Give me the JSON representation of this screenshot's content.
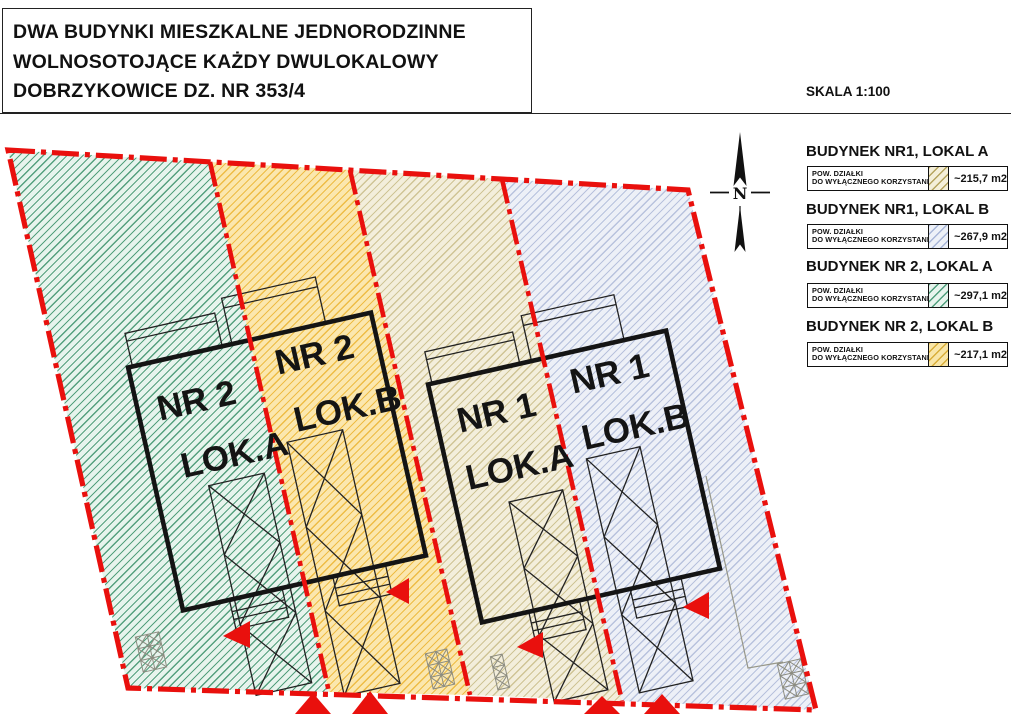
{
  "title": {
    "line1": "DWA BUDYNKI MIESZKALNE JEDNORODZINNE",
    "line2": "WOLNOSOTOJĄCE KAŻDY DWULOKALOWY",
    "line3": "DOBRZYKOWICE DZ. NR 353/4"
  },
  "scale_label": "SKALA 1:100",
  "north": {
    "label": "N"
  },
  "legend": {
    "row_label_line1": "POW. DZIAŁKI",
    "row_label_line2": "DO WYŁĄCZNEGO KORZYSTANIA",
    "entries": [
      {
        "heading": "BUDYNEK NR1, LOKAL A",
        "area": "~215,7 m2",
        "swatch_bg": "#f4efd9",
        "swatch_line": "#b5a45e"
      },
      {
        "heading": "BUDYNEK NR1, LOKAL B",
        "area": "~267,9 m2",
        "swatch_bg": "#edf1f8",
        "swatch_line": "#a8b6d8"
      },
      {
        "heading": "BUDYNEK NR 2, LOKAL A",
        "area": "~297,1 m2",
        "swatch_bg": "#e7f4ed",
        "swatch_line": "#4f9e7c"
      },
      {
        "heading": "BUDYNEK NR 2, LOKAL B",
        "area": "~217,1 m2",
        "swatch_bg": "#f9e6a8",
        "swatch_line": "#d9ae39"
      }
    ]
  },
  "plan": {
    "boundary_color": "#e9100d",
    "strips": [
      {
        "name": "budynek-nr2-lokal-a",
        "bg": "#e7f4ed",
        "line": "#55a07e"
      },
      {
        "name": "budynek-nr2-lokal-b",
        "bg": "#fbe7ae",
        "line": "#eebc45"
      },
      {
        "name": "budynek-nr1-lokal-a",
        "bg": "#f3eedb",
        "line": "#cfc495"
      },
      {
        "name": "budynek-nr1-lokal-b",
        "bg": "#edf0f7",
        "line": "#b8c2dd"
      }
    ],
    "building_labels": [
      {
        "line1": "NR 2",
        "line2": "LOK.A"
      },
      {
        "line1": "NR 2",
        "line2": "LOK.B"
      },
      {
        "line1": "NR 1",
        "line2": "LOK.A"
      },
      {
        "line1": "NR 1",
        "line2": "LOK.B"
      }
    ]
  }
}
